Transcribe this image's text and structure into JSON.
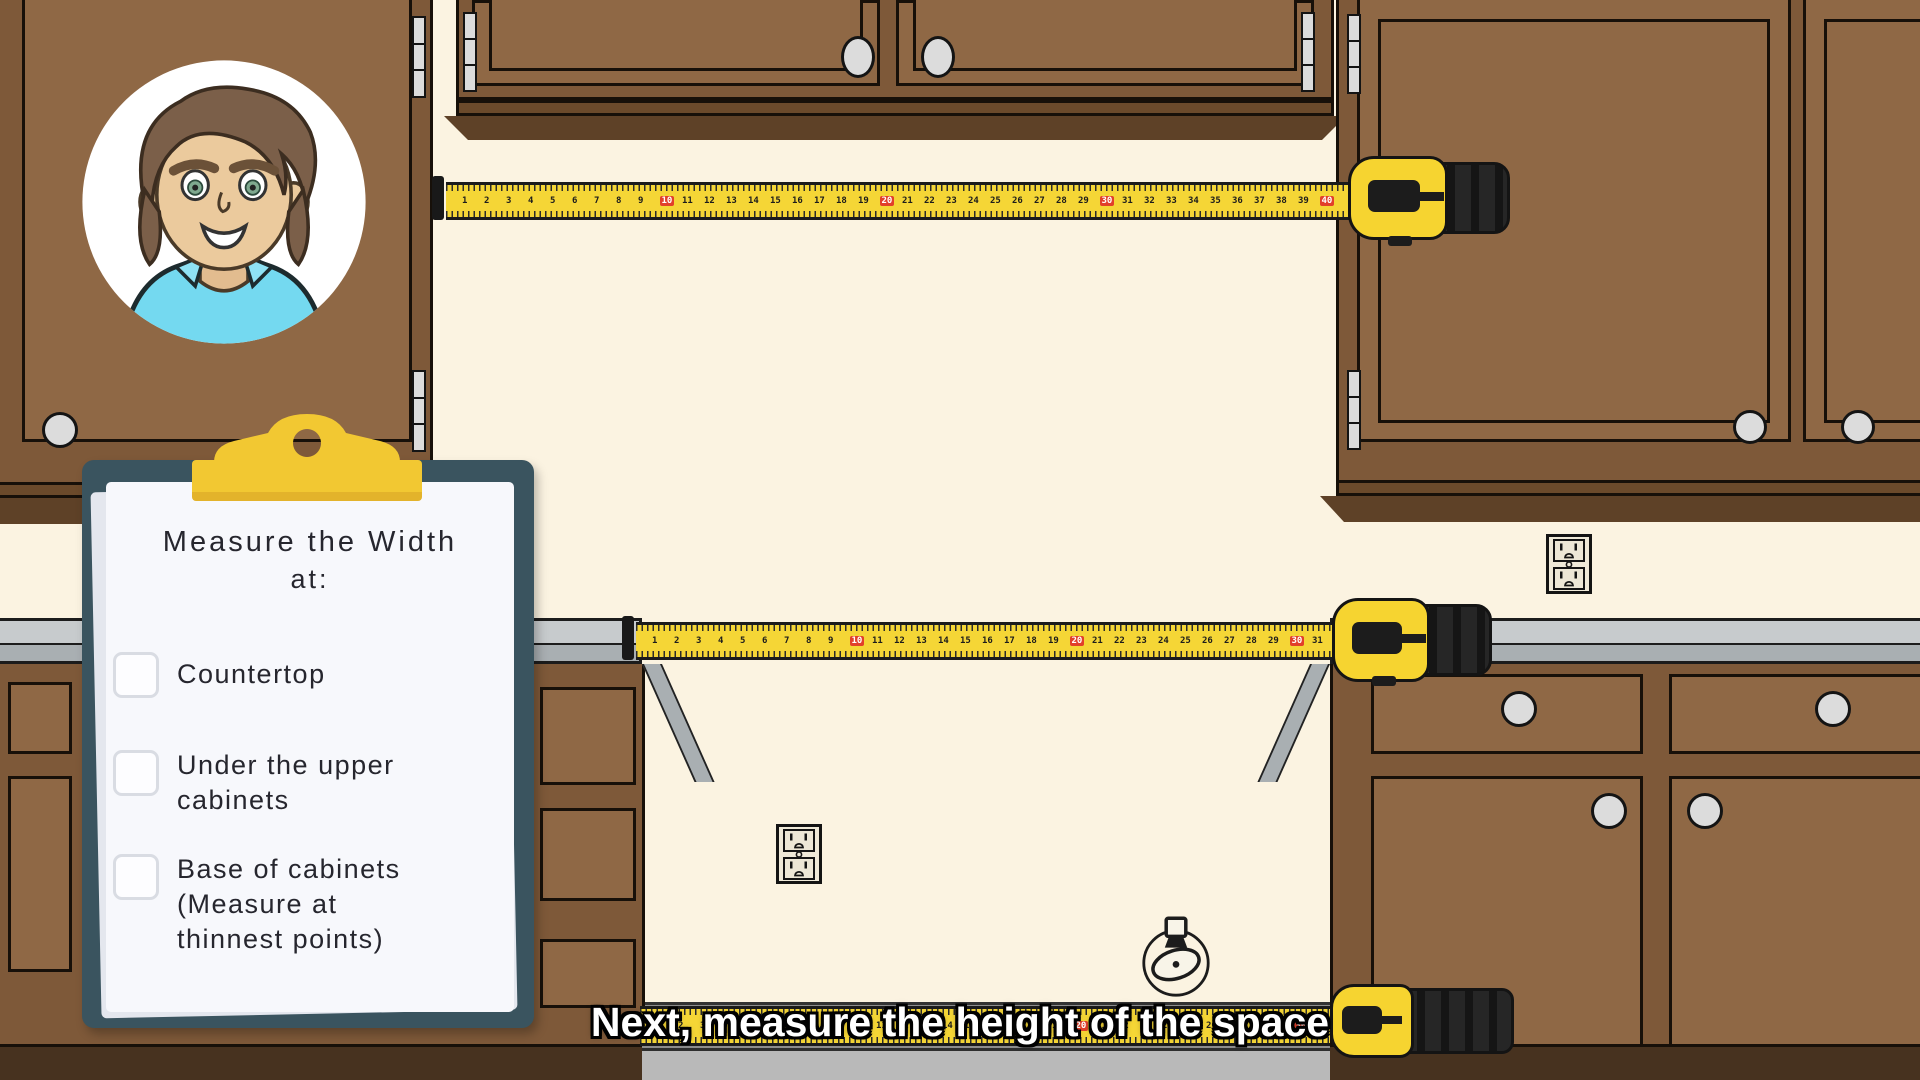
{
  "caption": {
    "text": "Next, measure the height of the space"
  },
  "clipboard": {
    "title_line1": "Measure the Width",
    "title_line2": "at:",
    "items": [
      {
        "label": "Countertop",
        "checked": false
      },
      {
        "label": "Under the upper cabinets",
        "checked": false
      },
      {
        "label": "Base of cabinets (Measure at thinnest points)",
        "checked": false
      }
    ]
  },
  "tape": {
    "number_start": 1,
    "spacing_px": 22,
    "red_interval": 10
  },
  "colors": {
    "wall": "#FBF3E1",
    "cabinet_face": "#8F6845",
    "cabinet_frame": "#7E5939",
    "trim_dark": "#5E4127",
    "counter_top": "#C7CBCD",
    "counter_front": "#A9AFB2",
    "tape_yellow": "#F5D636",
    "tape_red_mark": "#E2402A",
    "clip_yellow": "#F2C832",
    "board_slate": "#3A545F",
    "paper": "#F7F8FC",
    "floor_light": "#B9B9B9",
    "floor_dark": "#8D8D8D",
    "caption_text": "#FFFFFF"
  }
}
